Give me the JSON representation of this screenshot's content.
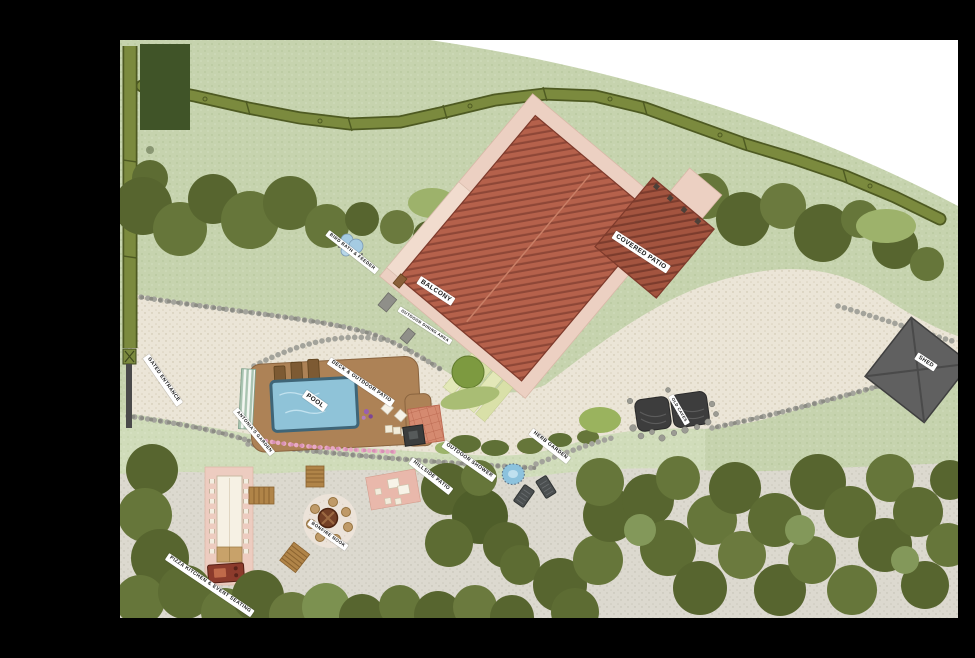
{
  "map": {
    "type": "property-site-plan",
    "labels": {
      "bird_bath": {
        "text": "BIRD BATH & FEEDER"
      },
      "balcony": {
        "text": "BALCONY"
      },
      "outdoor_dining": {
        "text": "OUTDOOR DINING AREA"
      },
      "covered_patio": {
        "text": "COVERED PATIO"
      },
      "gated_entrance": {
        "text": "GATED ENTRANCE"
      },
      "deck_patio": {
        "text": "DECK & OUTDOOR PATIO"
      },
      "pool": {
        "text": "POOL"
      },
      "antonias_garden": {
        "text": "ANTONIA'S GARDEN"
      },
      "outdoor_shower": {
        "text": "OUTDOOR SHOWER"
      },
      "herb_garden": {
        "text": "HERB GARDEN"
      },
      "hillside_patio": {
        "text": "HILLSIDE PATIO"
      },
      "old_caves": {
        "text": "OLD CAVES"
      },
      "shed": {
        "text": "SHED"
      },
      "pizza_kitchen": {
        "text": "PIZZA KITCHEN & EVENT SEATING"
      },
      "bonfire_nook": {
        "text": "BONFIRE NOOK"
      }
    },
    "colors": {
      "background": "#000000",
      "outside_boundary": "#ffffff",
      "grass": "#c6d3ae",
      "lawn": "#d0dcba",
      "driveway": "#ebe5d7",
      "terrace": "#dcd9cf",
      "roof": "#b5614b",
      "roof_stripe": "#8e4737",
      "patio_apron": "#ecd0c2",
      "deck_wood": "#ad8256",
      "pool_water": "#8fc3d8",
      "hedge": "#7b8a3e",
      "tree_dark": "#57652f",
      "shed_gray": "#606060",
      "pink_patio": "#edccc0",
      "label_bg": "#ffffff",
      "label_text": "#151515"
    }
  }
}
